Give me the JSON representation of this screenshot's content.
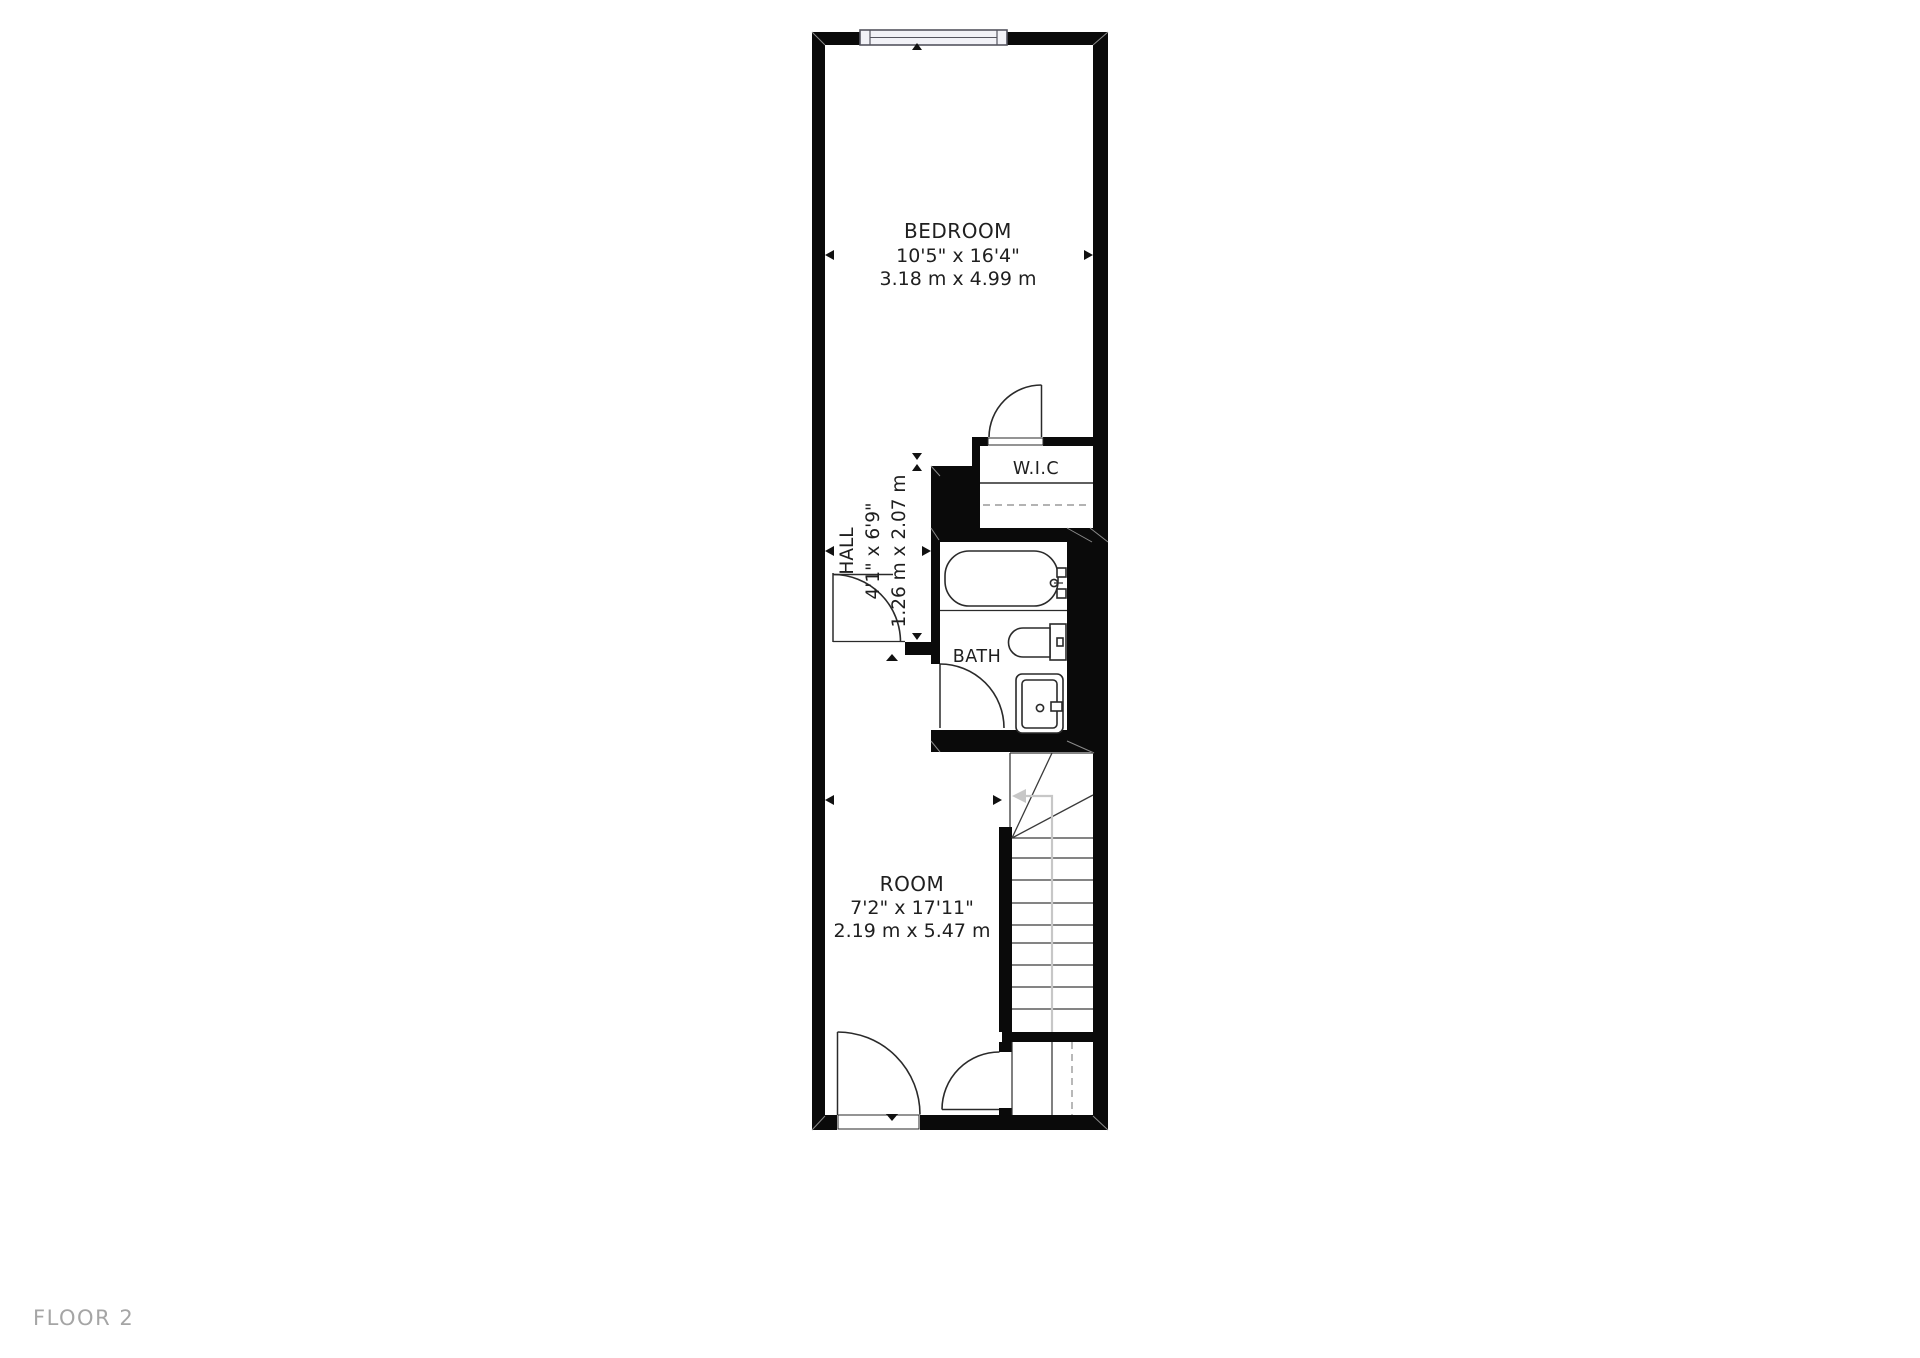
{
  "floor_plan": {
    "floor_label": "FLOOR 2",
    "rooms": [
      {
        "id": "bedroom",
        "name": "BEDROOM",
        "dim_imperial": "10'5\" x 16'4\"",
        "dim_metric": "3.18 m x 4.99 m"
      },
      {
        "id": "hall",
        "name": "HALL",
        "dim_imperial": "4'1\" x 6'9\"",
        "dim_metric": "1.26 m x 2.07 m"
      },
      {
        "id": "wic",
        "name": "W.I.C"
      },
      {
        "id": "bath",
        "name": "BATH"
      },
      {
        "id": "room",
        "name": "ROOM",
        "dim_imperial": "7'2\" x 17'11\"",
        "dim_metric": "2.19 m x 5.47 m"
      }
    ],
    "colors": {
      "wall": "#0a0a0a",
      "line": "#2a2a2a",
      "text": "#1f1f1f",
      "muted_text": "#a5a5a5",
      "walk_line": "#c7c7c7",
      "window_frame": "#55555f",
      "window_fill": "#f2f2f7",
      "dashed_line": "#9a9a9a",
      "background": "#ffffff"
    }
  }
}
